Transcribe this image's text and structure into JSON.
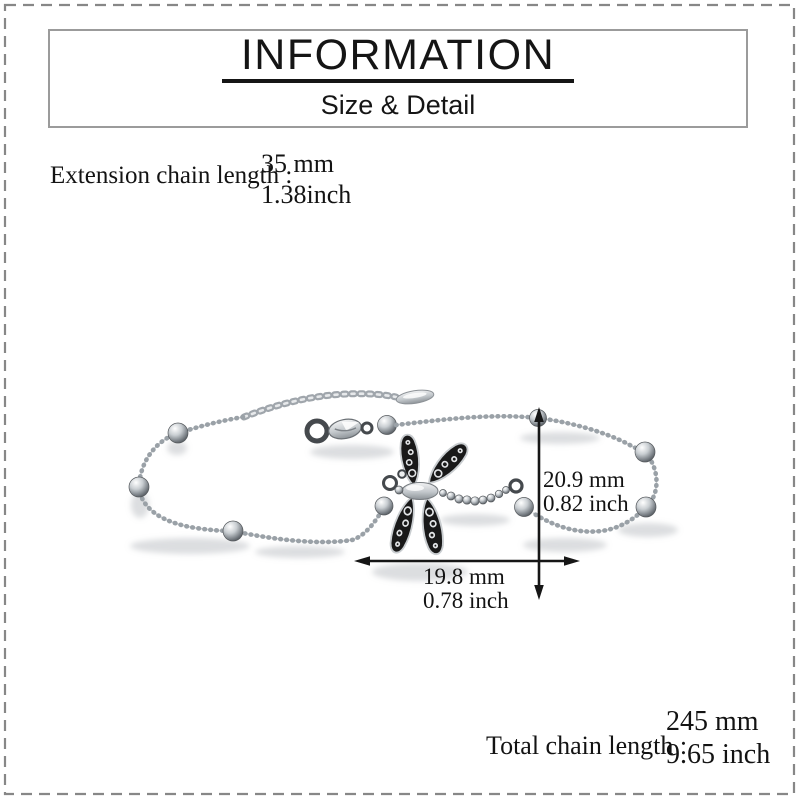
{
  "header": {
    "title": "INFORMATION",
    "subtitle": "Size & Detail"
  },
  "specs": {
    "extension": {
      "label": "Extension chain length :",
      "mm": "35 mm",
      "inch": "1.38inch"
    },
    "total": {
      "label": "Total chain length :",
      "mm": "245 mm",
      "inch": "9.65 inch"
    }
  },
  "dimensions": {
    "vertical": {
      "mm": "20.9 mm",
      "inch": "0.82 inch"
    },
    "horizontal": {
      "mm": "19.8 mm",
      "inch": "0.78 inch"
    }
  },
  "colors": {
    "text": "#131313",
    "dimension_arrow": "#161616",
    "dashed_border": "#878787",
    "header_box_border": "#9b9b9b",
    "title_underline": "#151515",
    "wing_dark": "#191919",
    "silver_mid": "#9aa1a7",
    "background": "#ffffff"
  }
}
